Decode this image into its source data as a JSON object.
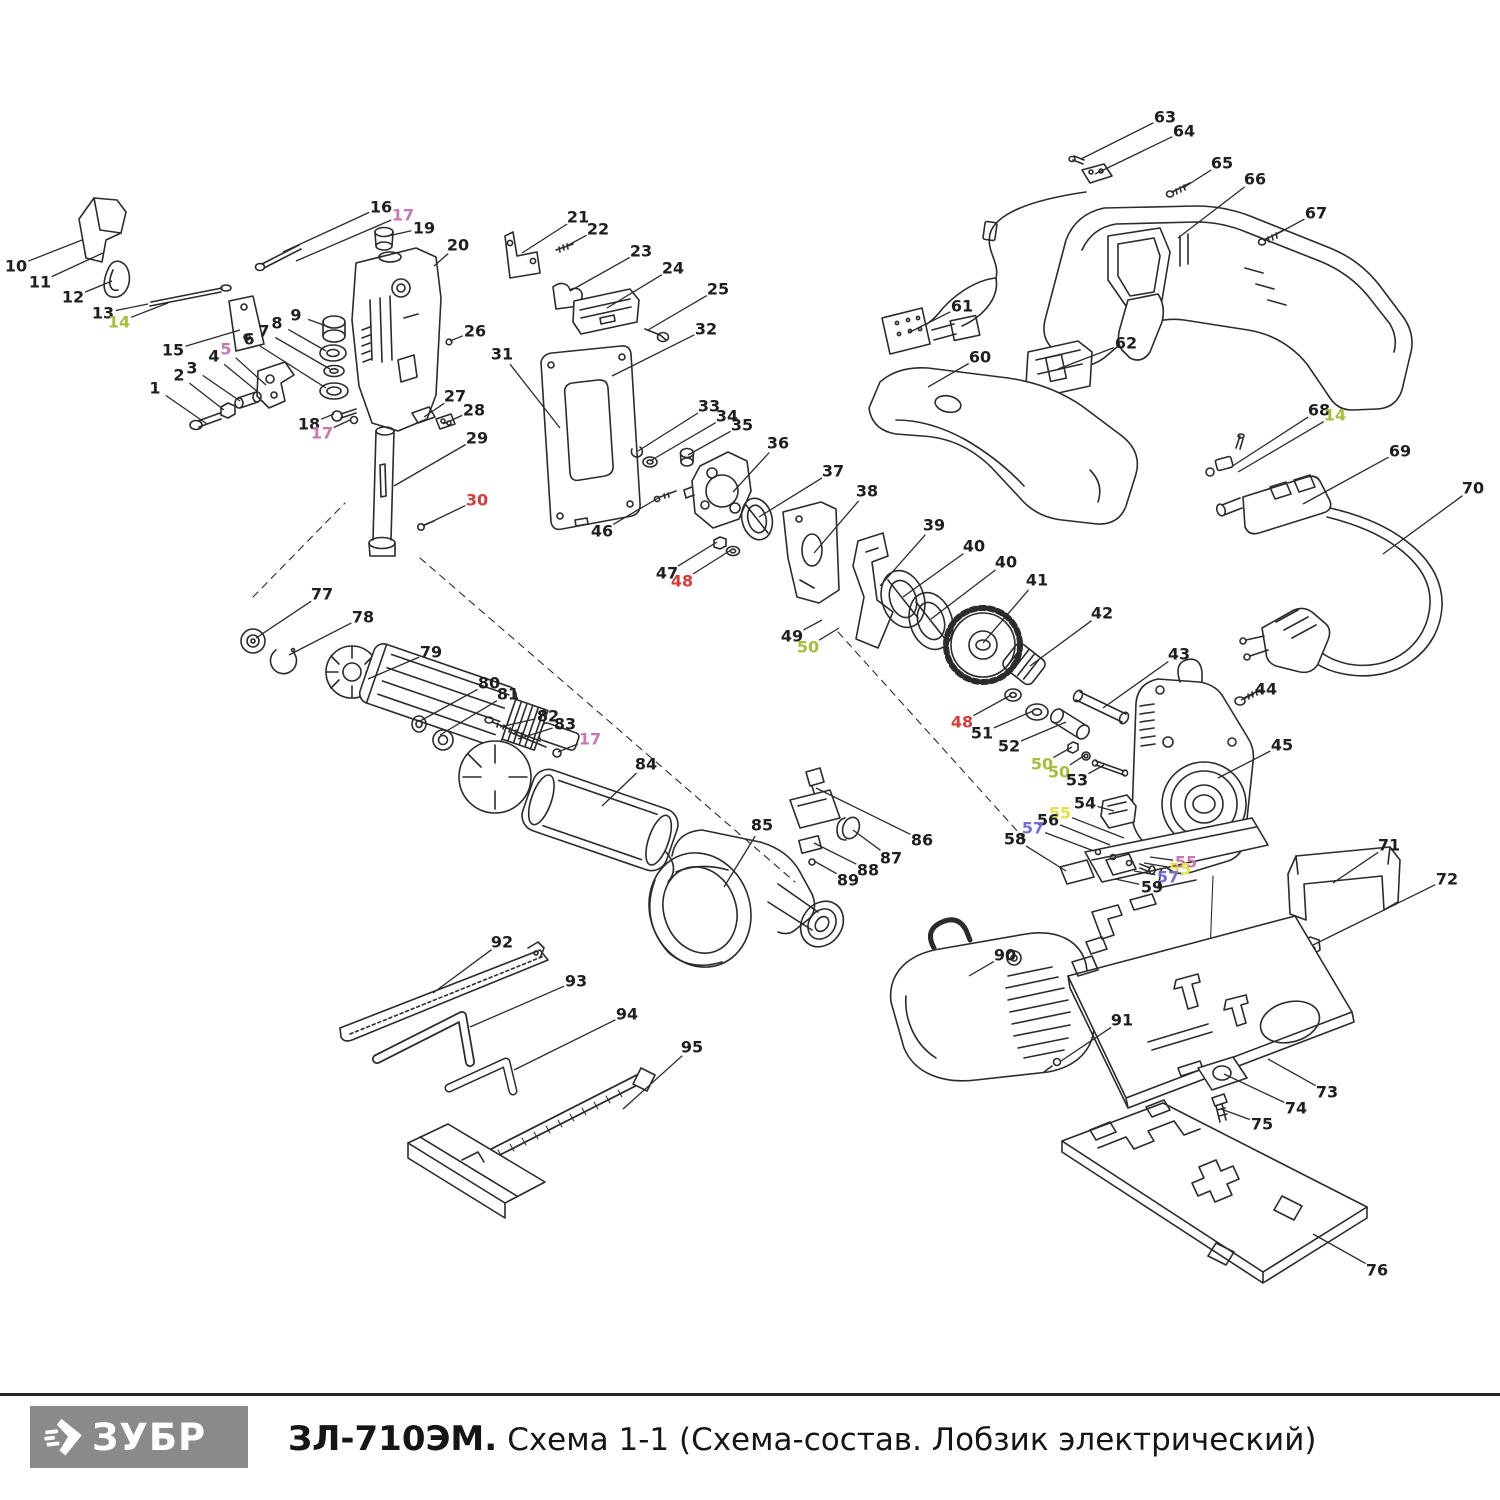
{
  "footer": {
    "logo_text": "ЗУБР",
    "title_model": "ЗЛ-710ЭМ.",
    "title_caption": "Схема 1-1 (Схема-состав. Лобзик электрический)"
  },
  "diagram": {
    "colors": {
      "k": "#1f1f1f",
      "red": "#d93b3b",
      "green": "#a4bf3b",
      "pink": "#c777b2",
      "blue": "#6f6fd9",
      "yellow": "#e8e049"
    },
    "labels": [
      {
        "n": "1",
        "x": 155,
        "y": 388,
        "tx": 207,
        "ty": 424
      },
      {
        "n": "2",
        "x": 179,
        "y": 375,
        "tx": 224,
        "ty": 410
      },
      {
        "n": "3",
        "x": 192,
        "y": 368,
        "tx": 240,
        "ty": 401
      },
      {
        "n": "4",
        "x": 214,
        "y": 356,
        "tx": 258,
        "ty": 392
      },
      {
        "n": "5",
        "c": "pink",
        "x": 226,
        "y": 349,
        "tx": 266,
        "ty": 385
      },
      {
        "n": "6",
        "x": 249,
        "y": 339,
        "tx": 326,
        "ty": 388
      },
      {
        "n": "7",
        "x": 264,
        "y": 331,
        "tx": 330,
        "ty": 369
      },
      {
        "n": "8",
        "x": 277,
        "y": 323,
        "tx": 326,
        "ty": 351
      },
      {
        "n": "9",
        "x": 296,
        "y": 315,
        "tx": 329,
        "ty": 327
      },
      {
        "n": "10",
        "x": 16,
        "y": 266,
        "tx": 82,
        "ty": 240
      },
      {
        "n": "11",
        "x": 40,
        "y": 282,
        "tx": 103,
        "ty": 253
      },
      {
        "n": "12",
        "x": 73,
        "y": 297,
        "tx": 112,
        "ty": 281
      },
      {
        "n": "13",
        "x": 103,
        "y": 313,
        "tx": 148,
        "ty": 304
      },
      {
        "n": "14",
        "c": "green",
        "x": 119,
        "y": 322,
        "tx": 168,
        "ty": 303
      },
      {
        "n": "15",
        "x": 173,
        "y": 350,
        "tx": 240,
        "ty": 330
      },
      {
        "n": "16",
        "x": 381,
        "y": 207,
        "tx": 283,
        "ty": 252
      },
      {
        "n": "17",
        "c": "pink",
        "x": 403,
        "y": 215,
        "tx": 296,
        "ty": 261
      },
      {
        "n": "18",
        "x": 309,
        "y": 424,
        "tx": 334,
        "ty": 414
      },
      {
        "n": "17",
        "c": "pink",
        "x": 322,
        "y": 433,
        "tx": 350,
        "ty": 420
      },
      {
        "n": "19",
        "x": 424,
        "y": 228,
        "tx": 388,
        "ty": 236
      },
      {
        "n": "20",
        "x": 458,
        "y": 245,
        "tx": 434,
        "ty": 266
      },
      {
        "n": "21",
        "x": 578,
        "y": 217,
        "tx": 522,
        "ty": 253
      },
      {
        "n": "22",
        "x": 598,
        "y": 229,
        "tx": 565,
        "ty": 247
      },
      {
        "n": "23",
        "x": 641,
        "y": 251,
        "tx": 570,
        "ty": 291
      },
      {
        "n": "24",
        "x": 673,
        "y": 268,
        "tx": 607,
        "ty": 308
      },
      {
        "n": "25",
        "x": 718,
        "y": 289,
        "tx": 648,
        "ty": 330
      },
      {
        "n": "26",
        "x": 475,
        "y": 331,
        "tx": 450,
        "ty": 341
      },
      {
        "n": "27",
        "x": 455,
        "y": 396,
        "tx": 424,
        "ty": 417
      },
      {
        "n": "28",
        "x": 474,
        "y": 410,
        "tx": 443,
        "ty": 424
      },
      {
        "n": "29",
        "x": 477,
        "y": 438,
        "tx": 394,
        "ty": 486
      },
      {
        "n": "30",
        "c": "red",
        "x": 477,
        "y": 500,
        "tx": 423,
        "ty": 526
      },
      {
        "n": "31",
        "x": 502,
        "y": 354,
        "tx": 560,
        "ty": 428
      },
      {
        "n": "32",
        "x": 706,
        "y": 329,
        "tx": 612,
        "ty": 376
      },
      {
        "n": "33",
        "x": 709,
        "y": 406,
        "tx": 638,
        "ty": 451
      },
      {
        "n": "34",
        "x": 727,
        "y": 416,
        "tx": 650,
        "ty": 461
      },
      {
        "n": "35",
        "x": 742,
        "y": 425,
        "tx": 688,
        "ty": 455
      },
      {
        "n": "36",
        "x": 778,
        "y": 443,
        "tx": 733,
        "ty": 492
      },
      {
        "n": "37",
        "x": 833,
        "y": 471,
        "tx": 759,
        "ty": 517
      },
      {
        "n": "38",
        "x": 867,
        "y": 491,
        "tx": 814,
        "ty": 553
      },
      {
        "n": "39",
        "x": 934,
        "y": 525,
        "tx": 880,
        "ty": 586
      },
      {
        "n": "40",
        "x": 974,
        "y": 546,
        "tx": 903,
        "ty": 597
      },
      {
        "n": "40",
        "x": 1006,
        "y": 562,
        "tx": 931,
        "ty": 619
      },
      {
        "n": "41",
        "x": 1037,
        "y": 580,
        "tx": 983,
        "ty": 643
      },
      {
        "n": "42",
        "x": 1102,
        "y": 613,
        "tx": 1030,
        "ty": 666
      },
      {
        "n": "43",
        "x": 1179,
        "y": 654,
        "tx": 1103,
        "ty": 708
      },
      {
        "n": "44",
        "x": 1266,
        "y": 689,
        "tx": 1241,
        "ty": 700
      },
      {
        "n": "45",
        "x": 1282,
        "y": 745,
        "tx": 1218,
        "ty": 778
      },
      {
        "n": "46",
        "x": 602,
        "y": 531,
        "tx": 660,
        "ty": 497
      },
      {
        "n": "47",
        "x": 667,
        "y": 573,
        "tx": 717,
        "ty": 542
      },
      {
        "n": "48",
        "c": "red",
        "x": 682,
        "y": 581,
        "tx": 731,
        "ty": 550
      },
      {
        "n": "48",
        "c": "red",
        "x": 962,
        "y": 722,
        "tx": 1011,
        "ty": 695
      },
      {
        "n": "49",
        "x": 792,
        "y": 636,
        "tx": 822,
        "ty": 620
      },
      {
        "n": "50",
        "c": "green",
        "x": 808,
        "y": 647,
        "tx": 839,
        "ty": 628
      },
      {
        "n": "50",
        "c": "green",
        "x": 1042,
        "y": 764,
        "tx": 1072,
        "ty": 747
      },
      {
        "n": "50",
        "c": "green",
        "x": 1059,
        "y": 772,
        "tx": 1085,
        "ty": 755
      },
      {
        "n": "51",
        "x": 982,
        "y": 733,
        "tx": 1033,
        "ty": 711
      },
      {
        "n": "52",
        "x": 1009,
        "y": 746,
        "tx": 1066,
        "ty": 722
      },
      {
        "n": "53",
        "x": 1077,
        "y": 780,
        "tx": 1104,
        "ty": 765
      },
      {
        "n": "54",
        "x": 1085,
        "y": 803,
        "tx": 1114,
        "ty": 811
      },
      {
        "n": "55",
        "c": "yellow",
        "x": 1060,
        "y": 813,
        "tx": 1124,
        "ty": 838
      },
      {
        "n": "56",
        "x": 1048,
        "y": 820,
        "tx": 1110,
        "ty": 845
      },
      {
        "n": "57",
        "c": "blue",
        "x": 1033,
        "y": 828,
        "tx": 1094,
        "ty": 851
      },
      {
        "n": "58",
        "x": 1015,
        "y": 839,
        "tx": 1066,
        "ty": 871
      },
      {
        "n": "55",
        "c": "pink",
        "x": 1186,
        "y": 862,
        "tx": 1150,
        "ty": 857
      },
      {
        "n": "55",
        "c": "yellow",
        "x": 1180,
        "y": 869,
        "tx": 1144,
        "ty": 863
      },
      {
        "n": "57",
        "c": "blue",
        "x": 1168,
        "y": 877,
        "tx": 1134,
        "ty": 871
      },
      {
        "n": "59",
        "x": 1152,
        "y": 887,
        "tx": 1115,
        "ty": 879
      },
      {
        "n": "60",
        "x": 980,
        "y": 357,
        "tx": 928,
        "ty": 387
      },
      {
        "n": "61",
        "x": 962,
        "y": 306,
        "tx": 908,
        "ty": 333
      },
      {
        "n": "62",
        "x": 1126,
        "y": 343,
        "tx": 1058,
        "ty": 369
      },
      {
        "n": "63",
        "x": 1165,
        "y": 117,
        "tx": 1081,
        "ty": 159
      },
      {
        "n": "64",
        "x": 1184,
        "y": 131,
        "tx": 1095,
        "ty": 174
      },
      {
        "n": "65",
        "x": 1222,
        "y": 163,
        "tx": 1183,
        "ty": 188
      },
      {
        "n": "66",
        "x": 1255,
        "y": 179,
        "tx": 1178,
        "ty": 238
      },
      {
        "n": "67",
        "x": 1316,
        "y": 213,
        "tx": 1275,
        "ty": 235
      },
      {
        "n": "68",
        "x": 1319,
        "y": 410,
        "tx": 1231,
        "ty": 467
      },
      {
        "n": "14",
        "c": "green",
        "x": 1335,
        "y": 415,
        "tx": 1238,
        "ty": 472
      },
      {
        "n": "69",
        "x": 1400,
        "y": 451,
        "tx": 1303,
        "ty": 504
      },
      {
        "n": "70",
        "x": 1473,
        "y": 488,
        "tx": 1383,
        "ty": 554
      },
      {
        "n": "71",
        "x": 1389,
        "y": 845,
        "tx": 1333,
        "ty": 883
      },
      {
        "n": "72",
        "x": 1447,
        "y": 879,
        "tx": 1313,
        "ty": 945
      },
      {
        "n": "73",
        "x": 1327,
        "y": 1092,
        "tx": 1268,
        "ty": 1059
      },
      {
        "n": "74",
        "x": 1296,
        "y": 1108,
        "tx": 1224,
        "ty": 1074
      },
      {
        "n": "75",
        "x": 1262,
        "y": 1124,
        "tx": 1221,
        "ty": 1109
      },
      {
        "n": "76",
        "x": 1377,
        "y": 1270,
        "tx": 1313,
        "ty": 1234
      },
      {
        "n": "77",
        "x": 322,
        "y": 594,
        "tx": 256,
        "ty": 638
      },
      {
        "n": "78",
        "x": 363,
        "y": 617,
        "tx": 289,
        "ty": 655
      },
      {
        "n": "79",
        "x": 431,
        "y": 652,
        "tx": 368,
        "ty": 679
      },
      {
        "n": "80",
        "x": 489,
        "y": 683,
        "tx": 420,
        "ty": 721
      },
      {
        "n": "81",
        "x": 508,
        "y": 694,
        "tx": 440,
        "ty": 735
      },
      {
        "n": "82",
        "x": 548,
        "y": 716,
        "tx": 500,
        "ty": 727
      },
      {
        "n": "83",
        "x": 565,
        "y": 724,
        "tx": 518,
        "ty": 739
      },
      {
        "n": "17",
        "c": "pink",
        "x": 590,
        "y": 739,
        "tx": 558,
        "ty": 752
      },
      {
        "n": "84",
        "x": 646,
        "y": 764,
        "tx": 602,
        "ty": 806
      },
      {
        "n": "85",
        "x": 762,
        "y": 825,
        "tx": 724,
        "ty": 887
      },
      {
        "n": "86",
        "x": 922,
        "y": 840,
        "tx": 816,
        "ty": 788
      },
      {
        "n": "87",
        "x": 891,
        "y": 858,
        "tx": 853,
        "ty": 830
      },
      {
        "n": "88",
        "x": 868,
        "y": 870,
        "tx": 814,
        "ty": 843
      },
      {
        "n": "89",
        "x": 848,
        "y": 880,
        "tx": 814,
        "ty": 861
      },
      {
        "n": "90",
        "x": 1005,
        "y": 955,
        "tx": 969,
        "ty": 976
      },
      {
        "n": "91",
        "x": 1122,
        "y": 1020,
        "tx": 1061,
        "ty": 1061
      },
      {
        "n": "92",
        "x": 502,
        "y": 942,
        "tx": 433,
        "ty": 993
      },
      {
        "n": "93",
        "x": 576,
        "y": 981,
        "tx": 470,
        "ty": 1027
      },
      {
        "n": "94",
        "x": 627,
        "y": 1014,
        "tx": 514,
        "ty": 1070
      },
      {
        "n": "95",
        "x": 692,
        "y": 1047,
        "tx": 623,
        "ty": 1109
      }
    ]
  }
}
